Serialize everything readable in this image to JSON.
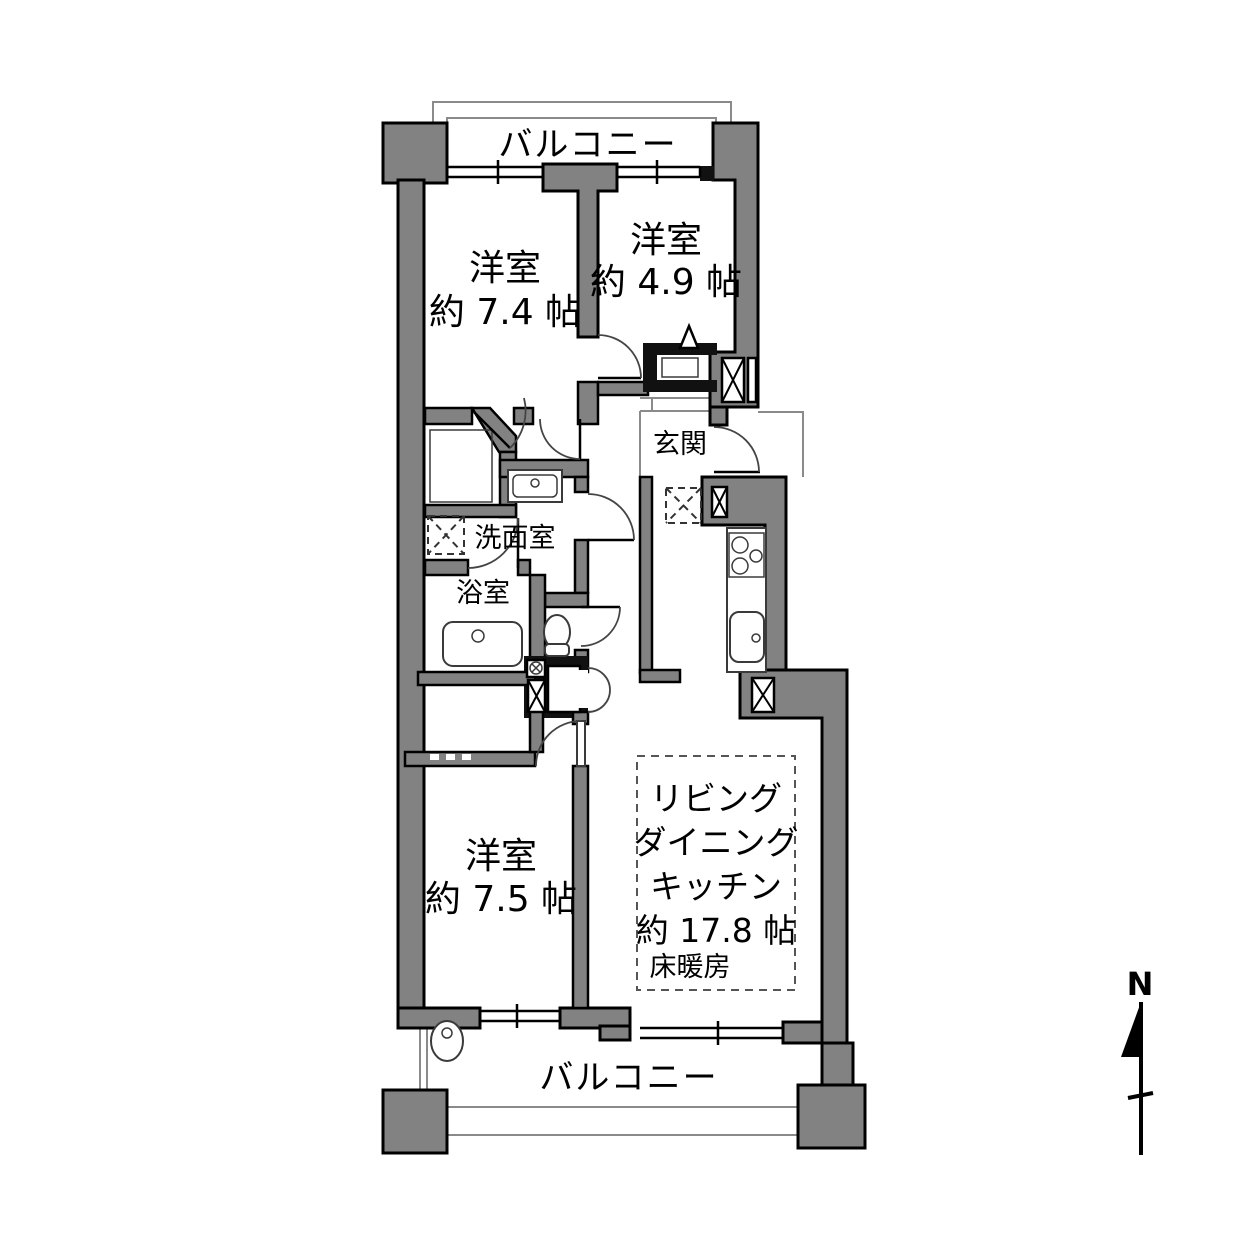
{
  "title": "apartment-floor-plan",
  "colors": {
    "wall": "#828282",
    "outline": "#000000",
    "thin_line": "#8a8a8a",
    "background": "#ffffff"
  },
  "balcony": {
    "top_label": "バルコニー",
    "bottom_label": "バルコニー"
  },
  "rooms": {
    "bedroom_74": {
      "name": "洋室",
      "size": "約 7.4 帖"
    },
    "bedroom_49": {
      "name": "洋室",
      "size": "約 4.9 帖"
    },
    "bedroom_75": {
      "name": "洋室",
      "size": "約 7.5 帖"
    },
    "entrance": {
      "name": "玄関"
    },
    "washroom": {
      "name": "洗面室"
    },
    "bathroom": {
      "name": "浴室"
    },
    "ldk": {
      "line1": "リビング",
      "line2": "ダイニング",
      "line3": "キッチン",
      "size": "約 17.8 帖",
      "floor_heating": "床暖房"
    }
  },
  "compass": {
    "north_label": "N"
  }
}
